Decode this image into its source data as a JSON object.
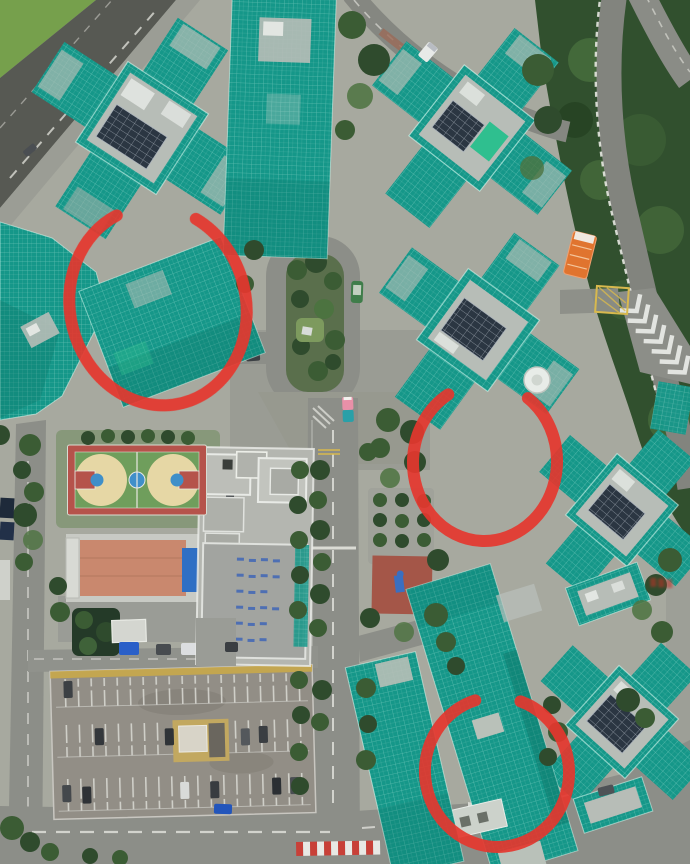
{
  "meta": {
    "type": "aerial-drone-photo",
    "width_px": 690,
    "height_px": 864
  },
  "annotations": {
    "tool": "freehand-red-circle",
    "count": 3,
    "items": [
      {
        "id": 1,
        "location": "upper-left scaffolded building"
      },
      {
        "id": 2,
        "location": "middle-right tower base"
      },
      {
        "id": 3,
        "location": "bottom-center scaffolded building"
      }
    ]
  },
  "scene": {
    "subject": "housing estate towers wrapped in green scaffolding netting",
    "landmarks": [
      "scaffolded-tower-cluster",
      "basketball-court",
      "community-building",
      "terracotta-roof-building",
      "carpark-deck",
      "loop-road",
      "central-road",
      "forest",
      "chevron-road-markings",
      "playground",
      "satellite-dish",
      "solar-panel-roof",
      "orange-truck",
      "green-minibus"
    ]
  },
  "colors": {
    "bg": "#a7a99f",
    "grass": "#76a04c",
    "forest": "#31502e",
    "tree": "#3b5c34",
    "tree_light": "#4c7340",
    "road": "#8c8e88",
    "road_dark": "#575953",
    "path": "#9b9d95",
    "scaffold": "#159789",
    "scaffold_dark": "#0c7467",
    "scaffold_bright": "#2fbf8f",
    "roof": "#b7bdb7",
    "roof_white": "#e2e6e2",
    "solar": "#2b3642",
    "court_red": "#b5534b",
    "court_green": "#6f9e5c",
    "court_tan": "#e6d7a5",
    "court_blue": "#3f8fc9",
    "terracotta": "#c9886e",
    "pool": "#2f6fc4",
    "deck": "#928e86",
    "deck_yellow": "#c9a94a",
    "white": "#e6e7e3",
    "yellow": "#d8b94e",
    "annotation": "#e5372e",
    "truck_orange": "#e0742f",
    "bus_green": "#3f7d4a",
    "car_dark": "#33373b",
    "car_blue": "#2a5fc8",
    "truck_pink": "#e890a8",
    "truck_teal": "#2aa0a8",
    "watermark": "#c03028"
  }
}
